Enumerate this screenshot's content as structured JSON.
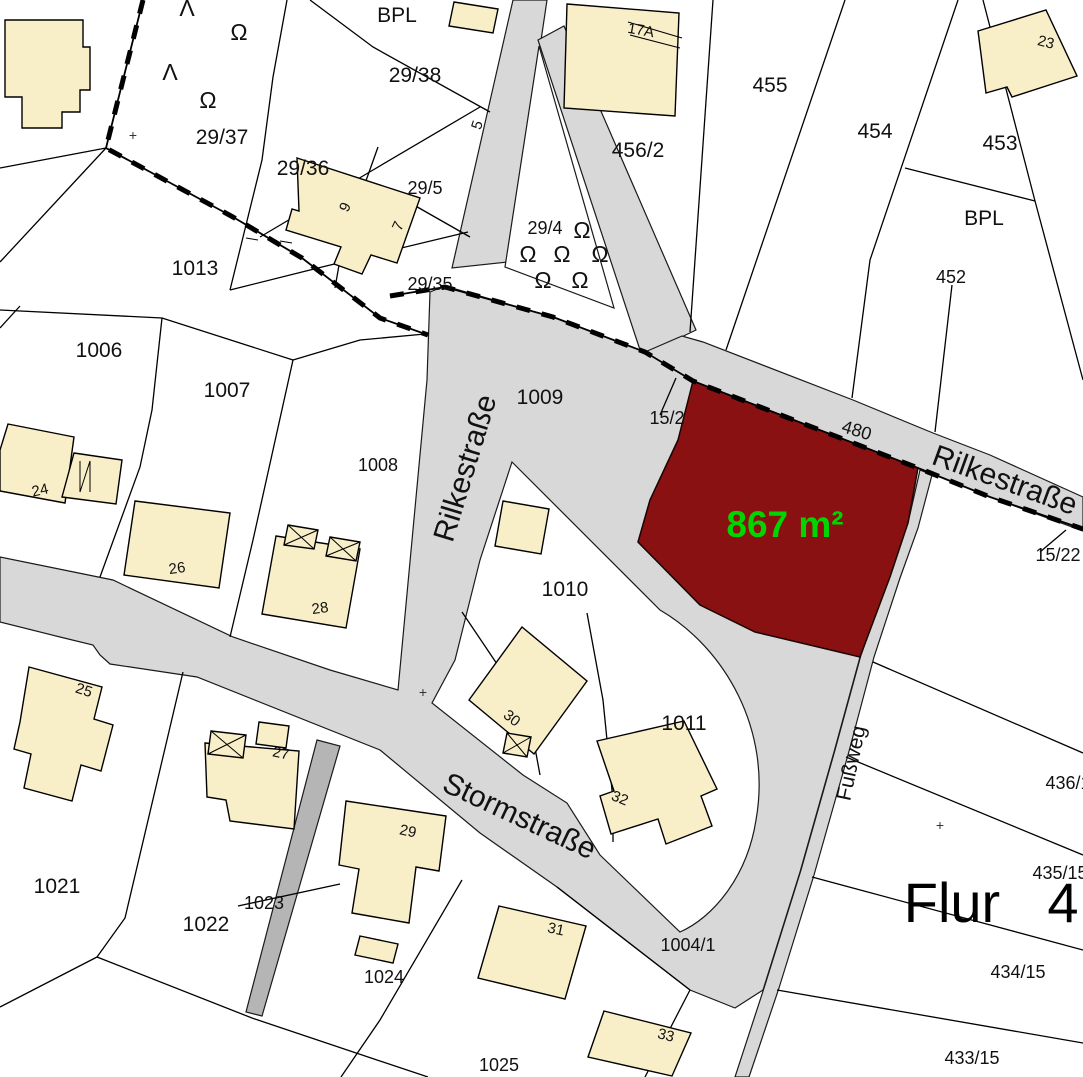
{
  "map": {
    "title": "Flurkarte cadastral map with highlighted parcel",
    "region": {
      "word": "Flur",
      "number": "4"
    },
    "highlight": {
      "area_text": "867 m²",
      "fill": "#8a1111",
      "text_color": "#00d500"
    },
    "street_names": {
      "rilke_v": "Rilkestraße",
      "rilke_d": "Rilkestraße",
      "storm": "Stormstraße",
      "fussweg": "Fußweg"
    },
    "zones": {
      "bpl_left": "BPL",
      "bpl_right": "BPL"
    },
    "parcels": {
      "p29_37": "29/37",
      "p29_36": "29/36",
      "p29_38": "29/38",
      "p29_5": "29/5",
      "p29_35": "29/35",
      "p29_4": "29/4",
      "p456_2": "456/2",
      "p455": "455",
      "p454": "454",
      "p453": "453",
      "p452": "452",
      "p1013": "1013",
      "p1006": "1006",
      "p1007": "1007",
      "p1008": "1008",
      "p1009": "1009",
      "p15_2": "15/2",
      "p480": "480",
      "p15_22": "15/22",
      "p1010": "1010",
      "p1011": "1011",
      "p1021": "1021",
      "p1022": "1022",
      "p1023": "1023",
      "p1024": "1024",
      "p1025": "1025",
      "p1004_1": "1004/1",
      "p436_1": "436/1",
      "p435_15": "435/15",
      "p434_15": "434/15",
      "p433_15": "433/15"
    },
    "house_numbers": {
      "h5": "5",
      "h7": "7",
      "h9": "9",
      "h17a": "17A",
      "h23": "23",
      "h24": "24",
      "h25": "25",
      "h26": "26",
      "h27": "27",
      "h28": "28",
      "h29": "29",
      "h30": "30",
      "h31": "31",
      "h32": "32",
      "h33": "33"
    },
    "symbols": {
      "tree": "Ω",
      "conifer": "Λ",
      "survey_cross": "+"
    },
    "colors": {
      "road": "#d8d8d8",
      "path_dark": "#b5b5b5",
      "building": "#f8eec7",
      "boundary": "#000000",
      "background": "#ffffff"
    }
  }
}
